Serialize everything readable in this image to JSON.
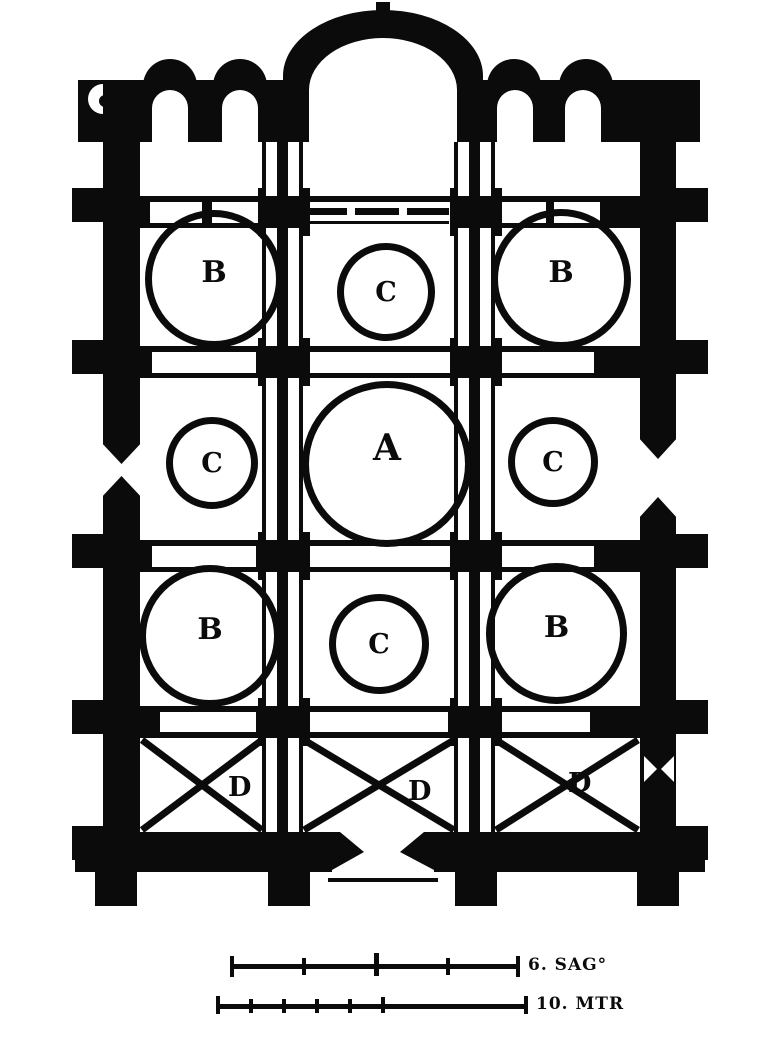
{
  "plan": {
    "dome_labels": {
      "nw": "B",
      "n": "C",
      "ne": "B",
      "w": "C",
      "center": "A",
      "e": "C",
      "sw": "B",
      "s": "C",
      "se": "B"
    },
    "narthex_bay_labels": [
      "D",
      "D",
      "D"
    ]
  },
  "scale_bars": [
    {
      "label": "6. SAG°"
    },
    {
      "label": "10. MTR"
    }
  ],
  "colors": {
    "ink": "#0b0b0b",
    "paper": "#ffffff"
  }
}
